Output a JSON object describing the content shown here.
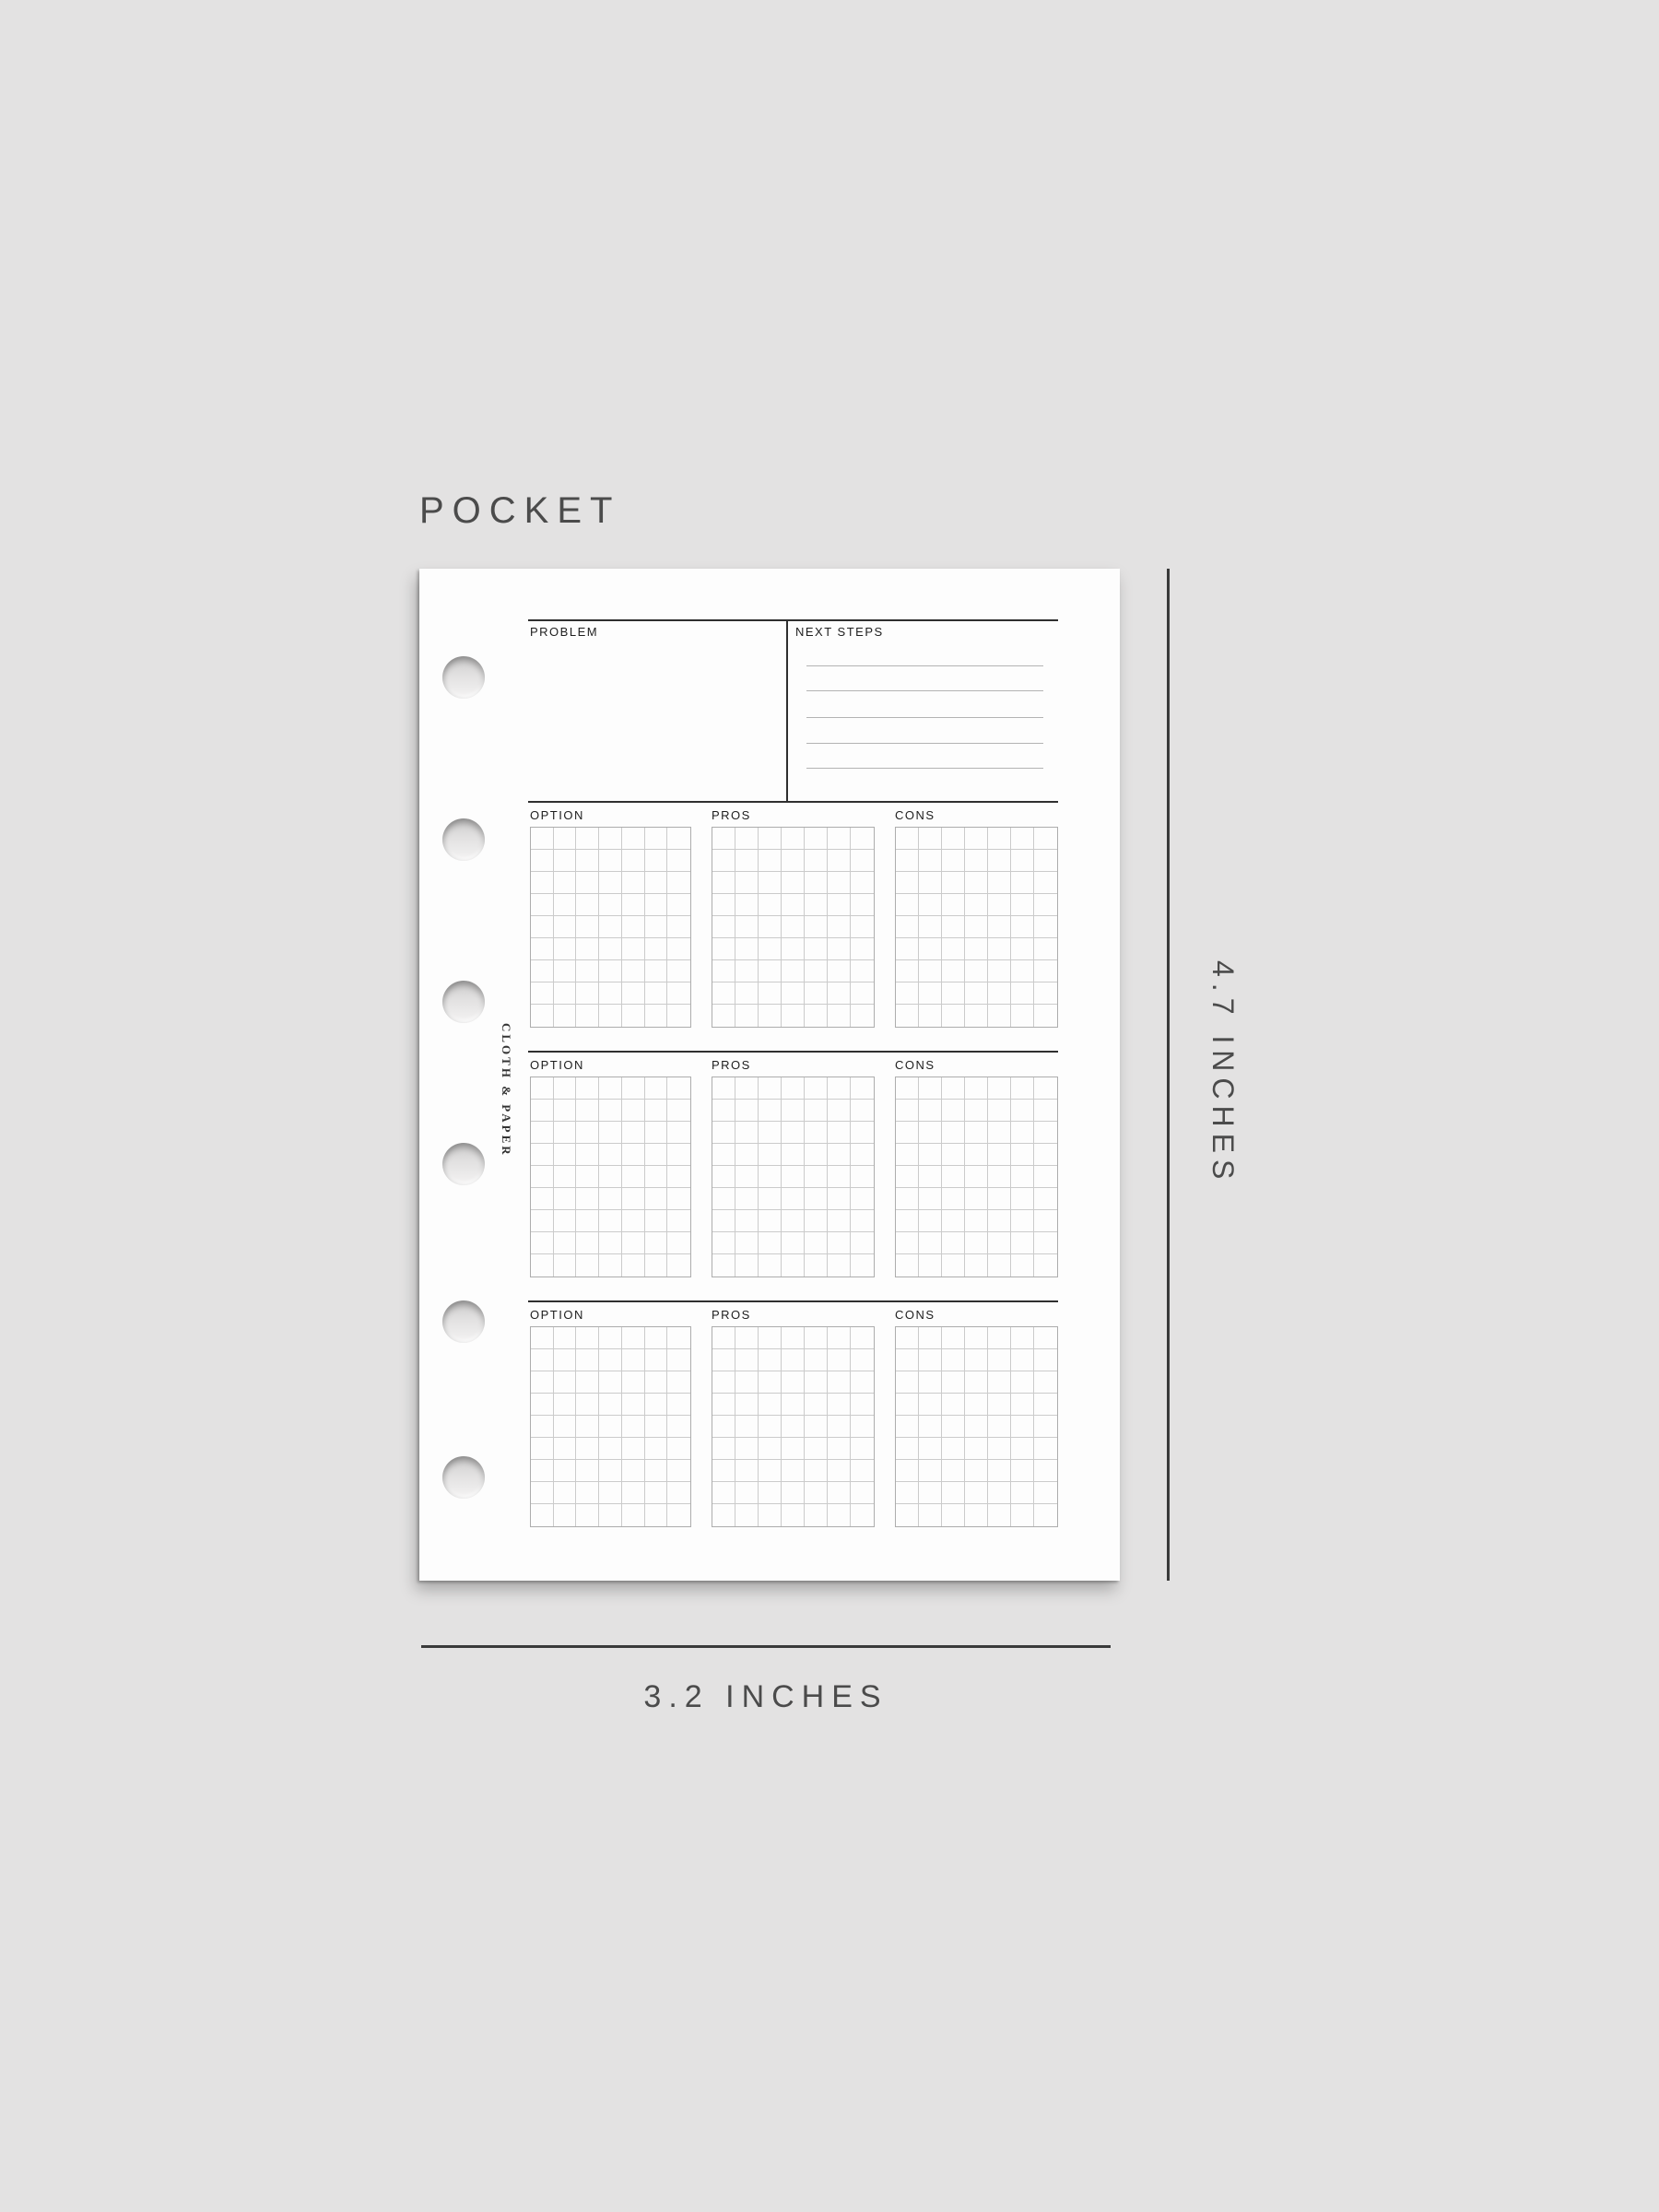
{
  "title": "POCKET",
  "brand": "CLOTH & PAPER",
  "dimensions": {
    "height_label": "4.7 INCHES",
    "width_label": "3.2 INCHES"
  },
  "page": {
    "header": {
      "problem_label": "PROBLEM",
      "next_steps_label": "NEXT STEPS",
      "next_steps_line_count": 5
    },
    "option_rows": [
      {
        "option_label": "OPTION",
        "pros_label": "PROS",
        "cons_label": "CONS"
      },
      {
        "option_label": "OPTION",
        "pros_label": "PROS",
        "cons_label": "CONS"
      },
      {
        "option_label": "OPTION",
        "pros_label": "PROS",
        "cons_label": "CONS"
      }
    ],
    "grid": {
      "columns": 7,
      "rows": 9
    },
    "binder_holes": 6
  },
  "colors": {
    "background": "#e3e2e2",
    "page": "#fdfdfd",
    "rule": "#2f2f2f",
    "grid_line": "#cbcbcb",
    "grid_border": "#adadad",
    "writing_line": "#b3b3b3",
    "dimension_line": "#3a3a3a",
    "muted_text": "#4b4b4b",
    "label_text": "#1e1e1e"
  }
}
